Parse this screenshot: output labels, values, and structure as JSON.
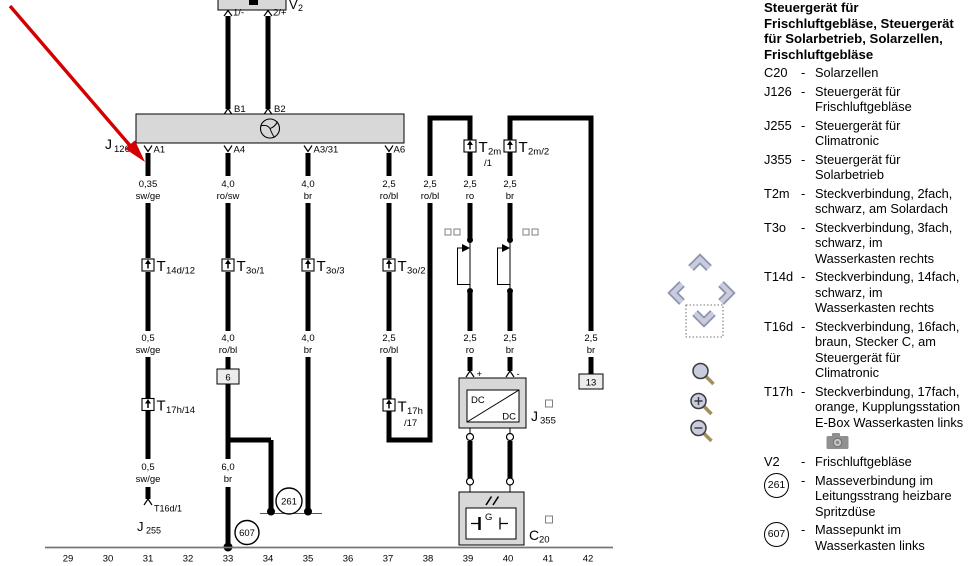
{
  "legend": {
    "title": "Steuergerät für Frischluftgebläse, Steuergerät für Solarbetrieb, Solarzellen, Frischluftgebläse",
    "dash": "-",
    "items": [
      {
        "key": "C20",
        "desc": "Solarzellen"
      },
      {
        "key": "J126",
        "desc": "Steuergerät für Frischluftgebläse"
      },
      {
        "key": "J255",
        "desc": "Steuergerät für Climatronic"
      },
      {
        "key": "J355",
        "desc": "Steuergerät für Solarbetrieb"
      },
      {
        "key": "T2m",
        "desc": "Steckverbindung, 2fach, schwarz, am Solardach"
      },
      {
        "key": "T3o",
        "desc": "Steckverbindung, 3fach, schwarz, im Wasserkasten rechts"
      },
      {
        "key": "T14d",
        "desc": "Steckverbindung, 14fach, schwarz, im Wasserkasten rechts"
      },
      {
        "key": "T16d",
        "desc": "Steckverbindung, 16fach, braun, Stecker C, am Steuergerät für Climatronic"
      },
      {
        "key": "T17h",
        "desc": "Steckverbindung, 17fach, orange, Kupplungsstation E-Box Wasserkasten links"
      },
      {
        "key": "V2",
        "desc": "Frischluftgebläse"
      },
      {
        "key": "261",
        "desc": "Masseverbindung im Leitungsstrang heizbare Spritzdüse",
        "circled": true
      },
      {
        "key": "607",
        "desc": "Massepunkt im Wasserkasten links",
        "circled": true
      }
    ]
  },
  "diagram": {
    "components": {
      "v2": {
        "letter": "V",
        "number": "2"
      },
      "j126": {
        "letter": "J",
        "number": "126"
      },
      "j255": {
        "letter": "J",
        "number": "255"
      },
      "j355": {
        "letter": "J",
        "number": "355"
      },
      "c20": {
        "letter": "C",
        "number": "20"
      },
      "dc_top": "DC",
      "dc_bottom": "DC",
      "generator": "G"
    },
    "pins": {
      "v2_1": "1/-",
      "v2_2": "2/+",
      "b1": "B1",
      "b2": "B2",
      "a1": "A1",
      "a4": "A4",
      "a3_31": "A3/31",
      "a6": "A6",
      "plus": "+",
      "minus": "-",
      "t16d1": "T16d/1"
    },
    "connectors": {
      "t14d12": {
        "t": "T",
        "sub": "14d/12"
      },
      "t3o1": {
        "t": "T",
        "sub": "3o/1"
      },
      "t3o3": {
        "t": "T",
        "sub": "3o/3"
      },
      "t3o2": {
        "t": "T",
        "sub": "3o/2"
      },
      "t2m1": {
        "t": "T",
        "sub": "2m",
        "sub2": "/1"
      },
      "t2m2": {
        "t": "T",
        "sub": "2m/2"
      },
      "t17h14": {
        "t": "T",
        "sub": "17h/14"
      },
      "t17h17": {
        "t": "T",
        "sub": "17h",
        "sub2": "/17"
      }
    },
    "wire_labels": {
      "row_a": [
        {
          "gauge": "0,35",
          "color": "sw/ge"
        },
        {
          "gauge": "4,0",
          "color": "ro/sw"
        },
        {
          "gauge": "4,0",
          "color": "br"
        },
        {
          "gauge": "2,5",
          "color": "ro/bl"
        },
        {
          "gauge": "2,5",
          "color": "ro/bl"
        },
        {
          "gauge": "2,5",
          "color": "ro"
        },
        {
          "gauge": "2,5",
          "color": "br"
        }
      ],
      "row_b": [
        {
          "gauge": "0,5",
          "color": "sw/ge"
        },
        {
          "gauge": "4,0",
          "color": "ro/bl"
        },
        {
          "gauge": "4,0",
          "color": "br"
        },
        {
          "gauge": "2,5",
          "color": "ro/bl"
        },
        {
          "gauge": "2,5",
          "color": "ro"
        },
        {
          "gauge": "2,5",
          "color": "br"
        },
        {
          "gauge": "2,5",
          "color": "br"
        }
      ],
      "row_c": [
        {
          "gauge": "0,5",
          "color": "sw/ge"
        },
        {
          "gauge": "6,0",
          "color": "br"
        }
      ]
    },
    "refs": {
      "track6": "6",
      "track13": "13"
    },
    "grounds": {
      "g261": "261",
      "g607": "607"
    },
    "tracks": [
      "29",
      "30",
      "31",
      "32",
      "33",
      "34",
      "35",
      "36",
      "37",
      "38",
      "39",
      "40",
      "41",
      "42"
    ]
  },
  "colors": {
    "wire": "#000000",
    "component_fill": "#d8d8d8",
    "arrow_red": "#d40000",
    "nav_chevron": "#c9ccdf",
    "lens_fill": "#c9cbdf"
  }
}
